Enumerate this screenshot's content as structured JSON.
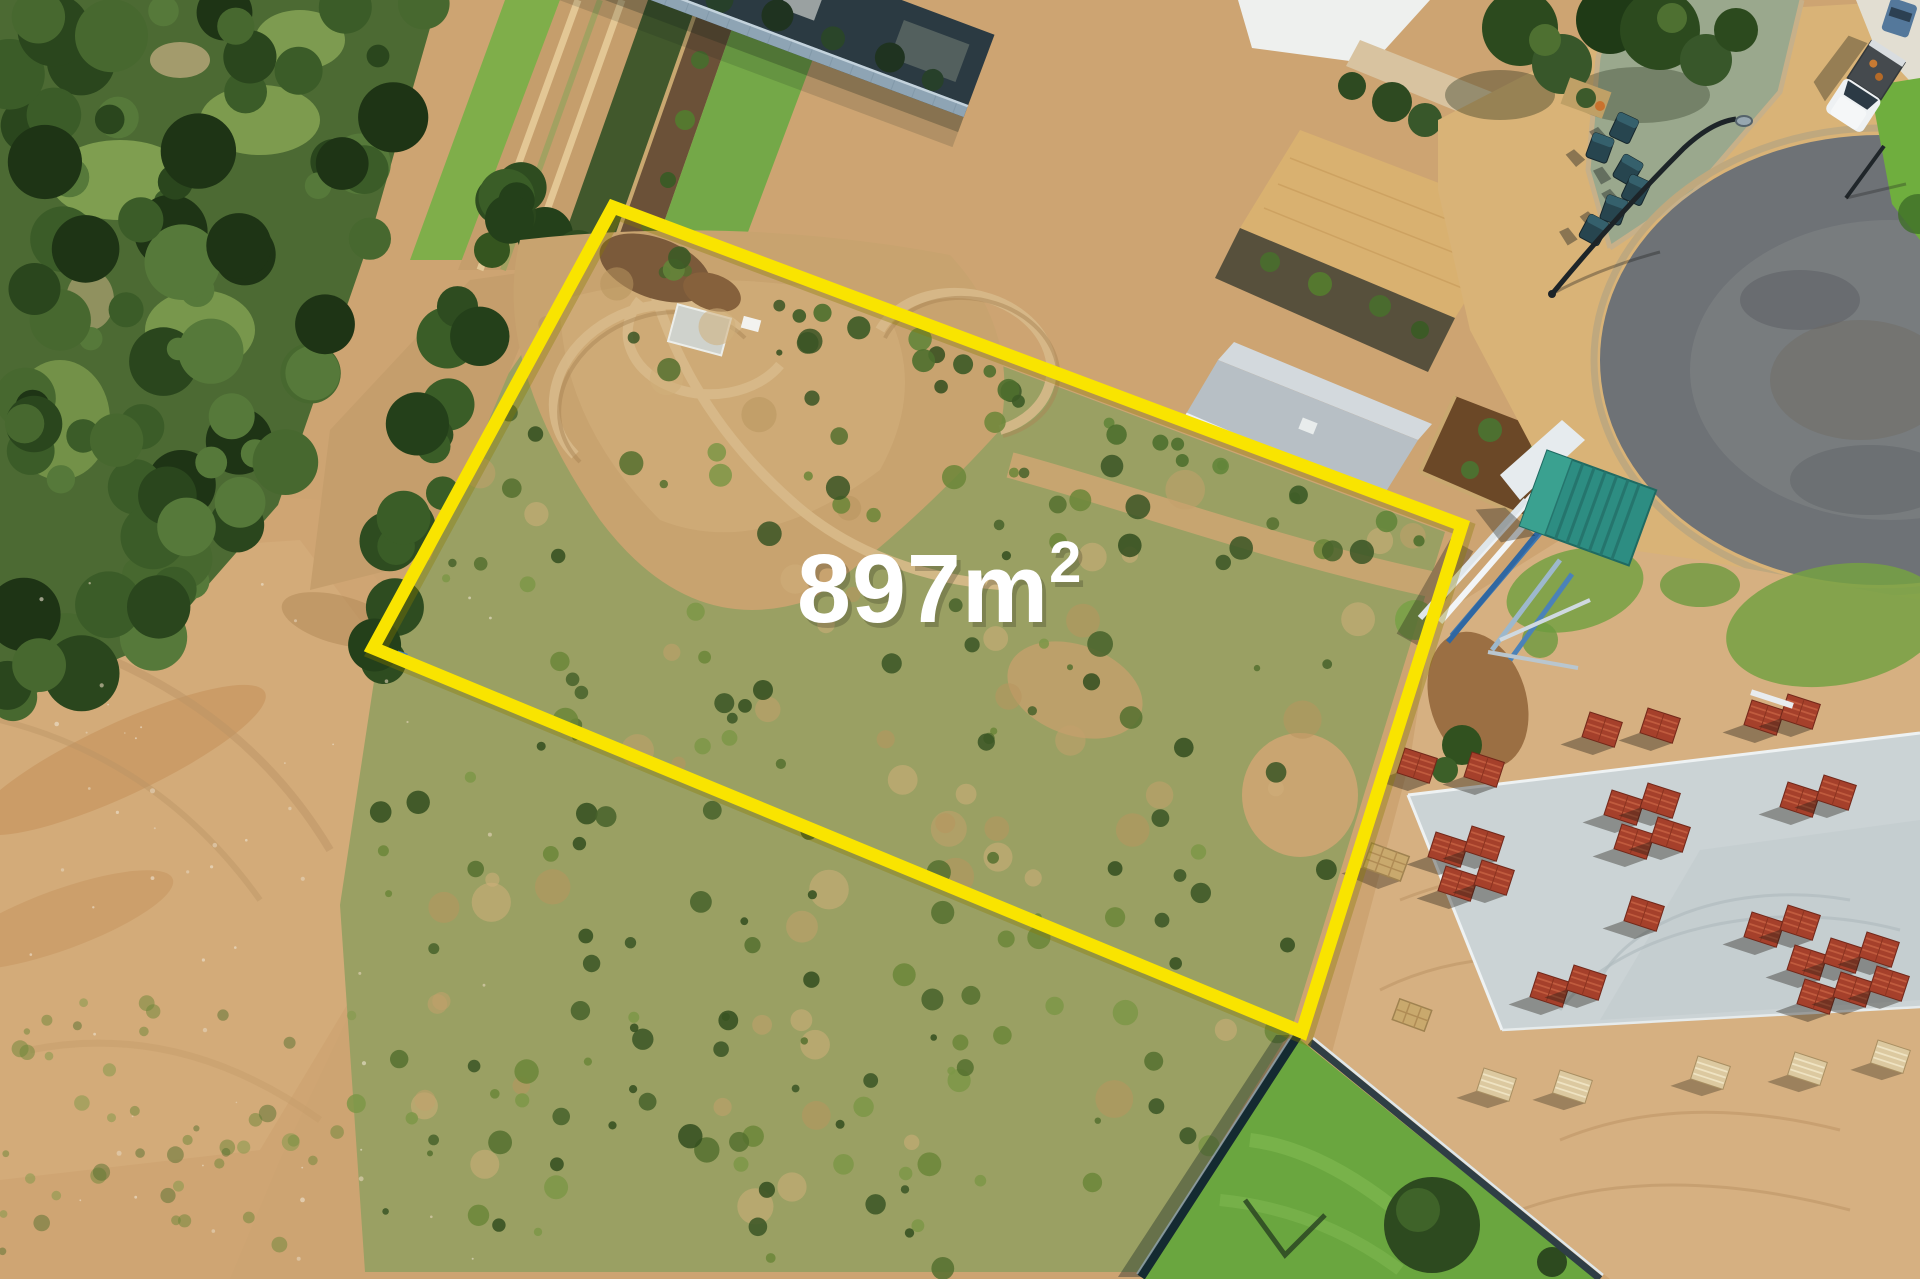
{
  "meta": {
    "kind": "aerial-drone-real-estate-photo",
    "canvas": {
      "width": 1920,
      "height": 1279
    }
  },
  "overlay": {
    "area_label": "897m²",
    "area_main": "897m",
    "area_sup": "2",
    "text_color": "#ffffff",
    "boundary_color": "#f9e400",
    "boundary_corners": [
      [
        613,
        207
      ],
      [
        1462,
        525
      ],
      [
        1302,
        1032
      ],
      [
        373,
        648
      ]
    ]
  },
  "scene": {
    "description": "Aerial view of a vacant 897 square metre residential block outlined in yellow: existing home with grey hip roof, timber deck, colorbond fence and trampoline along the top boundary; coastal bushland and a sandy dune track on the left; cul-de-sac street with brick paving, wheelie bins, street light and parked ute at top right; new home under construction at bottom right with concrete slab, pallets of red roof tiles, stacked steel wall frames and a teal site shed; lawn strip between dark fences at bottom.",
    "elements": [
      {
        "name": "vacant-lot",
        "label": "Vacant block of scrub and sand"
      },
      {
        "name": "boundary-outline",
        "label": "Yellow lot boundary"
      },
      {
        "name": "area-label",
        "label": "897m²"
      },
      {
        "name": "existing-house-roof",
        "label": "Grey hip roof house"
      },
      {
        "name": "veranda-deck",
        "label": "Timber deck veranda"
      },
      {
        "name": "colorbond-fence",
        "label": "Light blue-grey boundary fence"
      },
      {
        "name": "trampoline",
        "label": "Backyard trampoline"
      },
      {
        "name": "dirt-track",
        "label": "Sandy dune track"
      },
      {
        "name": "bushland",
        "label": "Dense coastal bushland"
      },
      {
        "name": "sand-dune",
        "label": "Bare sand dune area"
      },
      {
        "name": "cul-de-sac-road",
        "label": "Asphalt cul-de-sac with brick paving"
      },
      {
        "name": "street-light",
        "label": "Curved street light"
      },
      {
        "name": "wheelie-bins",
        "label": "Cluster of wheelie bins"
      },
      {
        "name": "parked-ute",
        "label": "White ute parked on driveway"
      },
      {
        "name": "construction-slab",
        "label": "Concrete house slab"
      },
      {
        "name": "roof-tile-pallets",
        "label": "Pallets of red roof tiles"
      },
      {
        "name": "steel-frames",
        "label": "Stacked steel wall frames"
      },
      {
        "name": "site-shed",
        "label": "Teal site shed"
      },
      {
        "name": "rear-fences",
        "label": "Dark rear fences"
      },
      {
        "name": "neighbour-lawn",
        "label": "Neighbouring lawn"
      },
      {
        "name": "mulch-garden",
        "label": "Mulched garden bed"
      }
    ]
  },
  "palette": {
    "sand": "#cda472",
    "sand_light": "#d7b183",
    "sand_orange": "#c08a52",
    "scrub": "#9aa063",
    "bush_dark": "#2a461d",
    "bush_mid": "#3b5c28",
    "lawn": "#6fae3e",
    "roof_white": "#f2f3f0",
    "roof_grey": "#b5bdc3",
    "fence": "#8ea4b4",
    "deck": "#7d5c41",
    "asphalt": "#6e7276",
    "paving": "#d9b377",
    "slab": "#cbd3d5",
    "tile_red": "#a5402b",
    "shed_teal": "#2d8d82",
    "steel_blue": "#3e78b2",
    "boundary_yellow": "#f9e400",
    "text_white": "#ffffff"
  }
}
